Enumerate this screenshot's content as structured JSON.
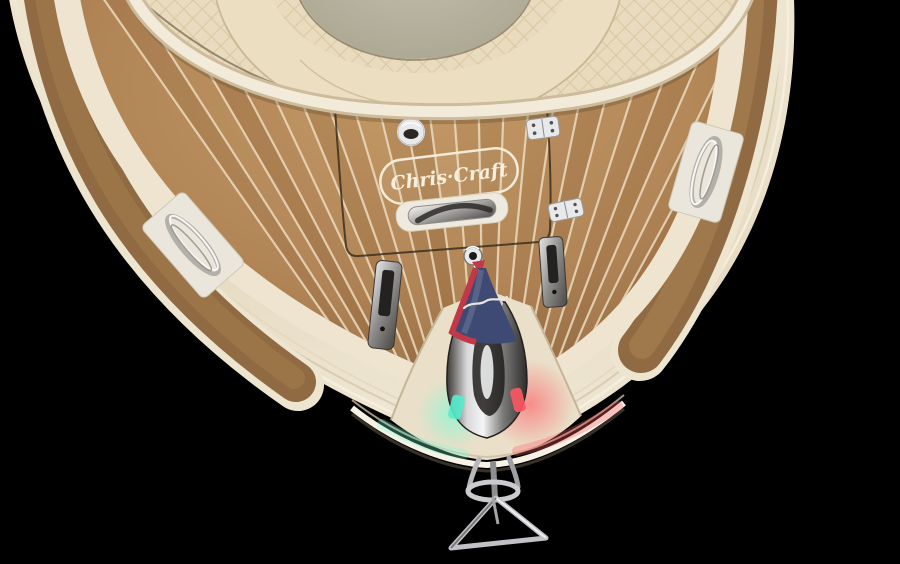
{
  "scene": {
    "description": "Overhead bow view of a classic Chris-Craft wooden-decked boat on a black background: teak foredeck with cream plank seams, cream quilted bow sunpad, chrome pop-up cleats, furled navy burgee flag with red trim on a chrome bow-light stem, green and red navigation light glow at the stem, and a polished stainless anchor hanging below the bow.",
    "background_color": "#000000"
  },
  "branding": {
    "logo_text": "Chris·Craft"
  },
  "icons": [
    "anchor-icon",
    "flag-icon",
    "cleat-icon",
    "hinge-icon",
    "latch-ring-icon"
  ],
  "palette": {
    "hull_cream": "#ebe1cb",
    "hull_highlight": "#f7f1e2",
    "hull_shadow": "#d7c9ad",
    "teak": "#a87e50",
    "teak_dark": "#84603c",
    "plank_seam": "#ecdcc0",
    "upholstery": "#e9dcbe",
    "center_pad": "#b5b19b",
    "flag_navy": "#3e4a74",
    "flag_red": "#c23848",
    "nav_green": "#55eccb",
    "nav_red": "#ff5763",
    "chrome_light": "#e8e9eb",
    "chrome_dark": "#3a3836"
  }
}
